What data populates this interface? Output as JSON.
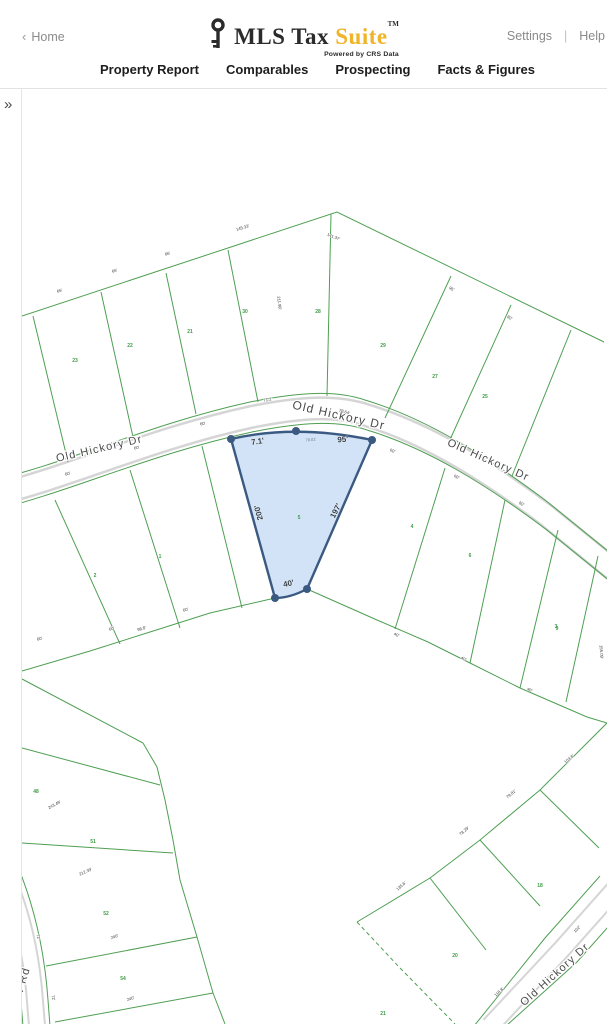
{
  "header": {
    "back_chevron": "‹",
    "home": "Home",
    "settings": "Settings",
    "divider": "|",
    "help": "Help"
  },
  "logo": {
    "title_dark": "MLS Tax",
    "title_accent": "Suite",
    "trademark": "TM",
    "tagline": "Powered by CRS Data",
    "accent_color": "#F0B429"
  },
  "nav": {
    "items": [
      {
        "label": "Property Report"
      },
      {
        "label": "Comparables"
      },
      {
        "label": "Prospecting"
      },
      {
        "label": "Facts & Figures"
      }
    ]
  },
  "map": {
    "sidebar_toggle": "»",
    "colors": {
      "parcel_line": "#4f9f53",
      "parcel_number": "#3f9c46",
      "dim_text": "#3b3b3b",
      "road_label": "#4a4a4a",
      "road_casing": "#d5d5d5",
      "subject_fill": "#cfe1f6",
      "subject_stroke": "#3a5a82"
    },
    "road_labels": [
      {
        "text": "Old Hickory Dr",
        "x": 100,
        "y": 452,
        "rot": -13,
        "size": 11
      },
      {
        "text": "Old Hickory Dr",
        "x": 338,
        "y": 419,
        "rot": 13,
        "size": 12
      },
      {
        "text": "Old Hickory Dr",
        "x": 487,
        "y": 463,
        "rot": 24,
        "size": 11
      },
      {
        "text": "Old Hickory Dr",
        "x": 557,
        "y": 977,
        "rot": -42,
        "size": 11
      },
      {
        "text": "iew Rd",
        "x": 24,
        "y": 988,
        "rot": -73,
        "size": 11
      }
    ],
    "parcel_numbers": [
      {
        "text": "34",
        "x": 18,
        "y": 387
      },
      {
        "text": "23",
        "x": 75,
        "y": 362
      },
      {
        "text": "22",
        "x": 130,
        "y": 347
      },
      {
        "text": "21",
        "x": 190,
        "y": 333
      },
      {
        "text": "30",
        "x": 245,
        "y": 313
      },
      {
        "text": "28",
        "x": 318,
        "y": 313
      },
      {
        "text": "29",
        "x": 383,
        "y": 347
      },
      {
        "text": "27",
        "x": 435,
        "y": 378
      },
      {
        "text": "25",
        "x": 485,
        "y": 398
      },
      {
        "text": "2",
        "x": 95,
        "y": 577
      },
      {
        "text": "1",
        "x": 160,
        "y": 558
      },
      {
        "text": "4",
        "x": 412,
        "y": 528
      },
      {
        "text": "6",
        "x": 470,
        "y": 557
      },
      {
        "text": "3",
        "x": 556,
        "y": 628
      },
      {
        "text": "9",
        "x": 557,
        "y": 630
      },
      {
        "text": "48",
        "x": 36,
        "y": 793
      },
      {
        "text": "51",
        "x": 93,
        "y": 843
      },
      {
        "text": "52",
        "x": 106,
        "y": 915
      },
      {
        "text": "54",
        "x": 123,
        "y": 980
      },
      {
        "text": "18",
        "x": 540,
        "y": 887
      },
      {
        "text": "20",
        "x": 455,
        "y": 957
      },
      {
        "text": "21",
        "x": 383,
        "y": 1015
      }
    ],
    "dim_labels": [
      {
        "text": "145.33'",
        "x": 243,
        "y": 229,
        "rot": -17
      },
      {
        "text": "141.37'",
        "x": 333,
        "y": 238,
        "rot": 22
      },
      {
        "text": "66'",
        "x": 60,
        "y": 292,
        "rot": -19
      },
      {
        "text": "66'",
        "x": 115,
        "y": 272,
        "rot": -18
      },
      {
        "text": "66'",
        "x": 168,
        "y": 255,
        "rot": -17
      },
      {
        "text": "211.98'",
        "x": 278,
        "y": 303,
        "rot": 84
      },
      {
        "text": "95'",
        "x": 451,
        "y": 290,
        "rot": 27
      },
      {
        "text": "80'",
        "x": 509,
        "y": 319,
        "rot": 29
      },
      {
        "text": "71.2'",
        "x": 268,
        "y": 401,
        "rot": -10
      },
      {
        "text": "78.64'",
        "x": 344,
        "y": 413,
        "rot": 16
      },
      {
        "text": "60'",
        "x": 68,
        "y": 475,
        "rot": -14
      },
      {
        "text": "60'",
        "x": 137,
        "y": 449,
        "rot": -13
      },
      {
        "text": "60'",
        "x": 203,
        "y": 425,
        "rot": -11
      },
      {
        "text": "60'",
        "x": 392,
        "y": 452,
        "rot": 24
      },
      {
        "text": "60'",
        "x": 456,
        "y": 478,
        "rot": 27
      },
      {
        "text": "60'",
        "x": 521,
        "y": 505,
        "rot": 29
      },
      {
        "text": "60'",
        "x": 40,
        "y": 640,
        "rot": -16
      },
      {
        "text": "60'",
        "x": 112,
        "y": 630,
        "rot": -15
      },
      {
        "text": "60'",
        "x": 186,
        "y": 611,
        "rot": -14
      },
      {
        "text": "40'",
        "x": 396,
        "y": 636,
        "rot": 24
      },
      {
        "text": "40'",
        "x": 463,
        "y": 660,
        "rot": 26
      },
      {
        "text": "40'",
        "x": 529,
        "y": 691,
        "rot": 27
      },
      {
        "text": "155.09'",
        "x": 600,
        "y": 652,
        "rot": 86
      },
      {
        "text": "98.8'",
        "x": 142,
        "y": 630,
        "rot": -17
      },
      {
        "text": "243.49'",
        "x": 55,
        "y": 806,
        "rot": -28
      },
      {
        "text": "212.39'",
        "x": 86,
        "y": 873,
        "rot": -24
      },
      {
        "text": "240'",
        "x": 115,
        "y": 938,
        "rot": -21
      },
      {
        "text": "240'",
        "x": 131,
        "y": 1000,
        "rot": -19
      },
      {
        "text": "72'",
        "x": 37,
        "y": 937,
        "rot": 80
      },
      {
        "text": "72'",
        "x": 52,
        "y": 998,
        "rot": 78
      },
      {
        "text": "103.8'",
        "x": 570,
        "y": 760,
        "rot": -40
      },
      {
        "text": "79.81'",
        "x": 512,
        "y": 795,
        "rot": -40
      },
      {
        "text": "78.29'",
        "x": 465,
        "y": 832,
        "rot": -40
      },
      {
        "text": "135.6'",
        "x": 402,
        "y": 887,
        "rot": -42
      },
      {
        "text": "118.8'",
        "x": 500,
        "y": 993,
        "rot": -44
      },
      {
        "text": "102'",
        "x": 578,
        "y": 930,
        "rot": -44
      }
    ],
    "subject_parcel": {
      "number": "5",
      "number_x": 299,
      "number_y": 519,
      "dims": [
        {
          "text": "7.1'",
          "x": 258,
          "y": 444,
          "rot": -9
        },
        {
          "text": "78.01'",
          "x": 311,
          "y": 441,
          "rot": -5,
          "small": true
        },
        {
          "text": "95'",
          "x": 343,
          "y": 442,
          "rot": -5
        },
        {
          "text": "200'",
          "x": 261,
          "y": 512,
          "rot": -105
        },
        {
          "text": "197'",
          "x": 338,
          "y": 512,
          "rot": -63
        },
        {
          "text": "40'",
          "x": 289,
          "y": 586,
          "rot": -12
        }
      ],
      "vertices": [
        [
          231,
          439
        ],
        [
          296,
          431
        ],
        [
          372,
          440
        ],
        [
          307,
          589
        ],
        [
          275,
          598
        ]
      ]
    }
  }
}
